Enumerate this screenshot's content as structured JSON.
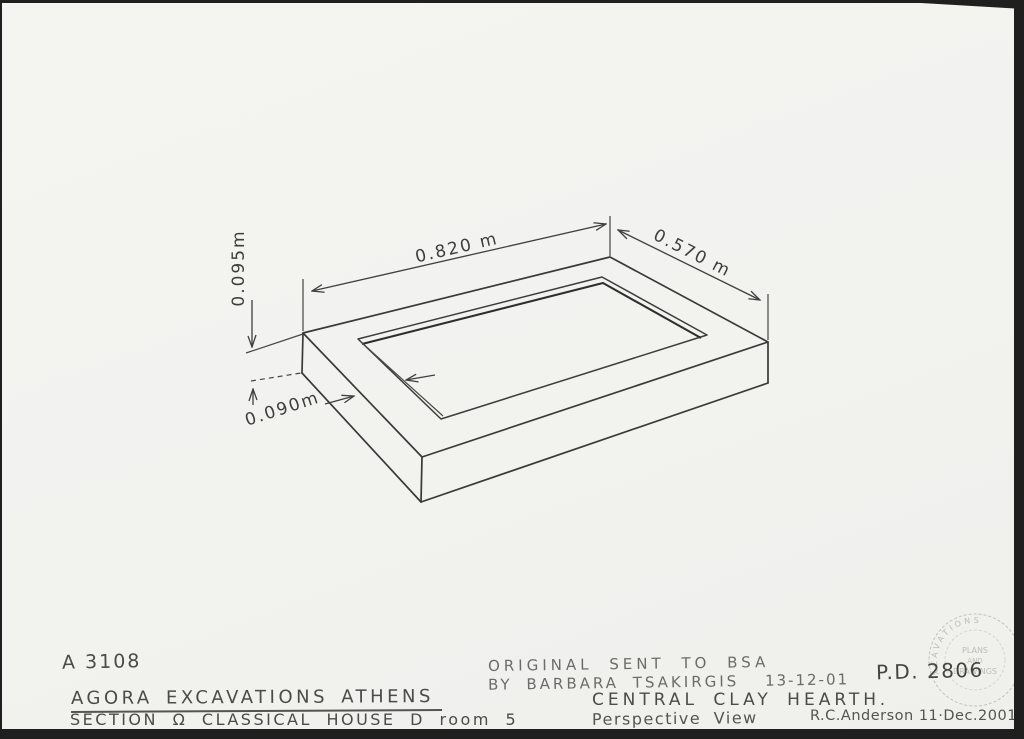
{
  "labels": {
    "inventory_no": "A 3108",
    "site_line": "AGORA EXCAVATIONS ATHENS",
    "location_line": "SECTION Ω CLASSICAL HOUSE D room 5",
    "note_line1": "ORIGINAL SENT TO BSA",
    "note_line2": "BY BARBARA TSAKIRGIS",
    "note_date": "13-12-01",
    "drawing_no": "P.D. 2806",
    "subject": "CENTRAL CLAY HEARTH.",
    "view": "Perspective View",
    "credit": "R.C.Anderson 11·Dec.2001"
  },
  "dimensions": {
    "height": "0.095m",
    "length": "0.820 m",
    "width": "0.570 m",
    "rim": "0.090m"
  },
  "stamp": {
    "arc_text": "EXCAVATIONS",
    "line1": "PLANS",
    "line2": "AND",
    "line3": "DRAWINGS"
  },
  "colors": {
    "paper": "#f3f2ef",
    "drawing_ink": "#3c3c3d",
    "hand_ink": "#4b4b48",
    "scan_edge": "#1f1f1f",
    "stamp_ink": "#b6b4ab"
  }
}
